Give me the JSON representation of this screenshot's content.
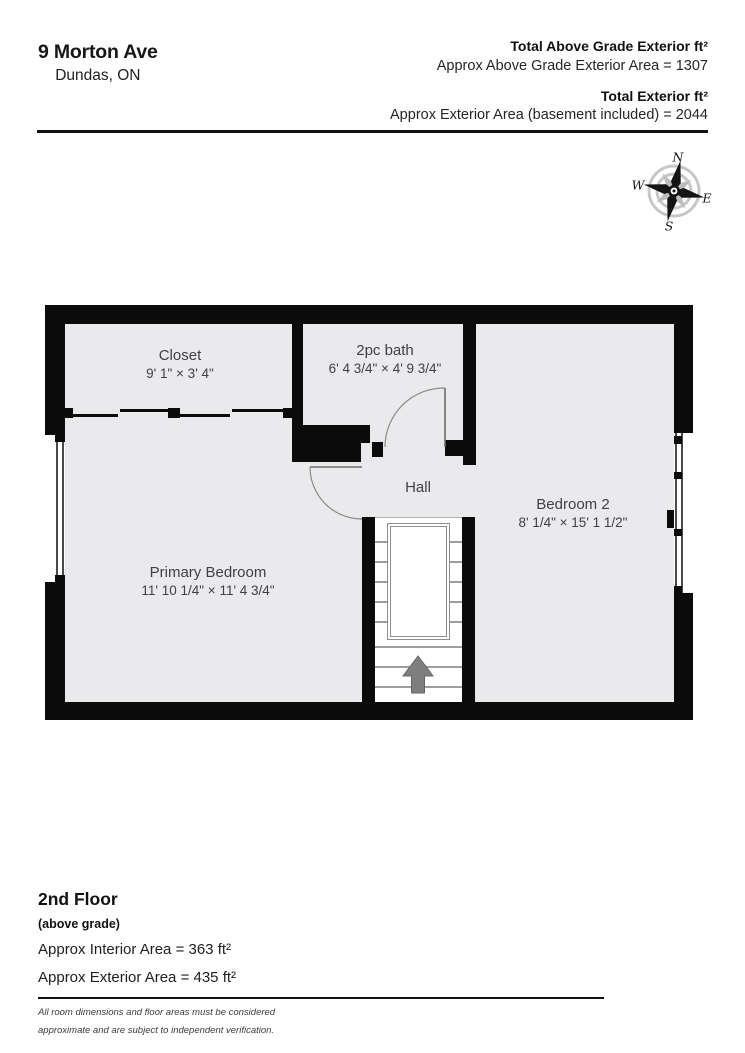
{
  "header": {
    "address_line1": "9 Morton Ave",
    "address_line2": "Dundas, ON",
    "total_above_label": "Total Above Grade Exterior ft²",
    "total_above_value": "Approx Above Grade Exterior Area = 1307",
    "total_ext_label": "Total Exterior ft²",
    "total_ext_value": "Approx Exterior Area (basement included) = 2044"
  },
  "compass": {
    "north": "N",
    "east": "E",
    "south": "S",
    "west": "W"
  },
  "floorplan": {
    "rooms": {
      "closet": {
        "name": "Closet",
        "dims": "9' 1\" × 3' 4\""
      },
      "bath": {
        "name": "2pc bath",
        "dims": "6' 4 3/4\" × 4' 9 3/4\""
      },
      "hall": {
        "name": "Hall"
      },
      "bedroom2": {
        "name": "Bedroom 2",
        "dims": "8' 1/4\" × 15' 1 1/2\""
      },
      "primary": {
        "name": "Primary Bedroom",
        "dims": "11' 10 1/4\" × 11' 4 3/4\""
      }
    }
  },
  "footer": {
    "floor_title": "2nd Floor",
    "floor_subtitle": "(above grade)",
    "interior_area": "Approx Interior Area = 363 ft²",
    "exterior_area": "Approx Exterior Area = 435 ft²",
    "disclaimer_line1": "All room dimensions and floor areas must be considered",
    "disclaimer_line2": "approximate and are subject to independent verification."
  },
  "colors": {
    "wall": "#0b0b0b",
    "floor": "#eaeaec",
    "step_line": "#9e9e9e",
    "label_text": "#3f4042"
  }
}
